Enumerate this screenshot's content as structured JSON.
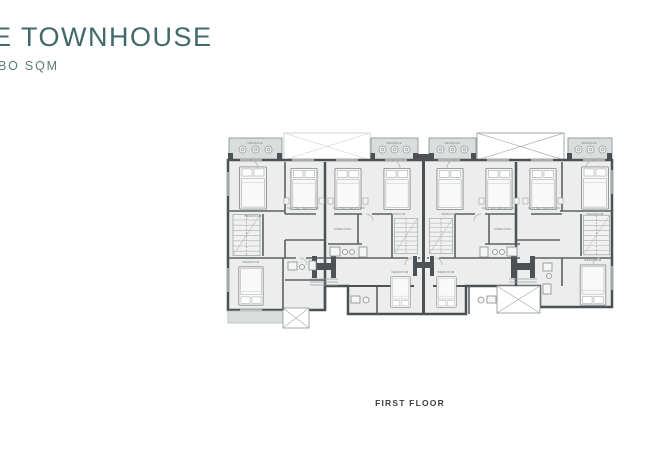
{
  "header": {
    "title": "E TOWNHOUSE",
    "subtitle": "BO SQM"
  },
  "plan": {
    "caption": "FIRST FLOOR",
    "labels": {
      "terrace": "TERRACE",
      "master_bedroom": "MASTER BEDROOM",
      "bedroom": "BEDROOM",
      "dressing": "DRESSING"
    }
  },
  "colors": {
    "title_teal": "#41686a",
    "subtitle_teal": "#5b7b79",
    "caption_dark": "#3b4043",
    "wall_dark": "#4b5154",
    "floor_fill": "#ecedec",
    "terrace_fill": "#d9dedd",
    "line_light": "#a7adad"
  }
}
